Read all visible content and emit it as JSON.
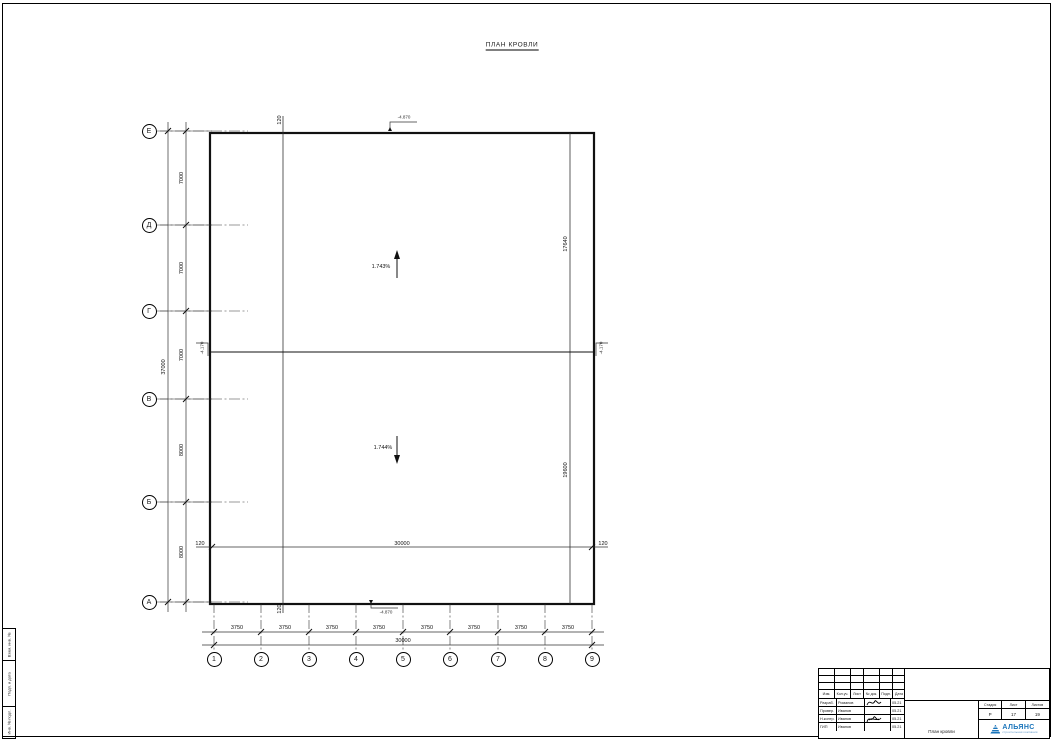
{
  "drawing": {
    "title": "ПЛАН КРОВЛИ"
  },
  "grid": {
    "row_axes": [
      "Е",
      "Д",
      "Г",
      "В",
      "Б",
      "А"
    ],
    "row_dims": [
      "7000",
      "7000",
      "7000",
      "8000",
      "8000"
    ],
    "row_total": "37000",
    "col_axes": [
      "1",
      "2",
      "3",
      "4",
      "5",
      "6",
      "7",
      "8",
      "9"
    ],
    "col_dims": [
      "3750",
      "3750",
      "3750",
      "3750",
      "3750",
      "3750",
      "3750",
      "3750"
    ],
    "col_total": "30000"
  },
  "roof": {
    "slope_upper": "1.743%",
    "slope_lower": "1.744%",
    "offset_left": "120",
    "offset_right": "120",
    "offset_top": "120",
    "offset_bottom": "120",
    "inner_width": "30000",
    "upper_panel_depth": "17640",
    "lower_panel_depth": "19600",
    "elev_top": "-4.870",
    "elev_bottom": "-4.870",
    "elev_ridge_left": "-4.170",
    "elev_ridge_right": "-4.170"
  },
  "side_stamp": {
    "cells": [
      "Взам. инв. №",
      "Подп. и дата",
      "Инв. № подл."
    ]
  },
  "title_block": {
    "header_cols": [
      "Изм.",
      "Кол.уч.",
      "Лист",
      "№ док.",
      "Подп.",
      "Дата"
    ],
    "rows": [
      {
        "role": "Разраб.",
        "name": "Романов",
        "date": "05.21"
      },
      {
        "role": "Провер.",
        "name": "Иванов",
        "date": "05.21"
      },
      {
        "role": "Н.контр.",
        "name": "Иванов",
        "date": "05.21"
      },
      {
        "role": "ГИП",
        "name": "Иванов",
        "date": "05.21"
      }
    ],
    "stage_label": "Стадия",
    "sheet_label": "Лист",
    "sheets_label": "Листов",
    "stage": "Р",
    "sheet": "17",
    "sheets": "19",
    "doc_title": "План кровли",
    "company": {
      "name": "АЛЬЯНС",
      "tagline": "строительная компания",
      "color": "#1b75bb"
    }
  }
}
